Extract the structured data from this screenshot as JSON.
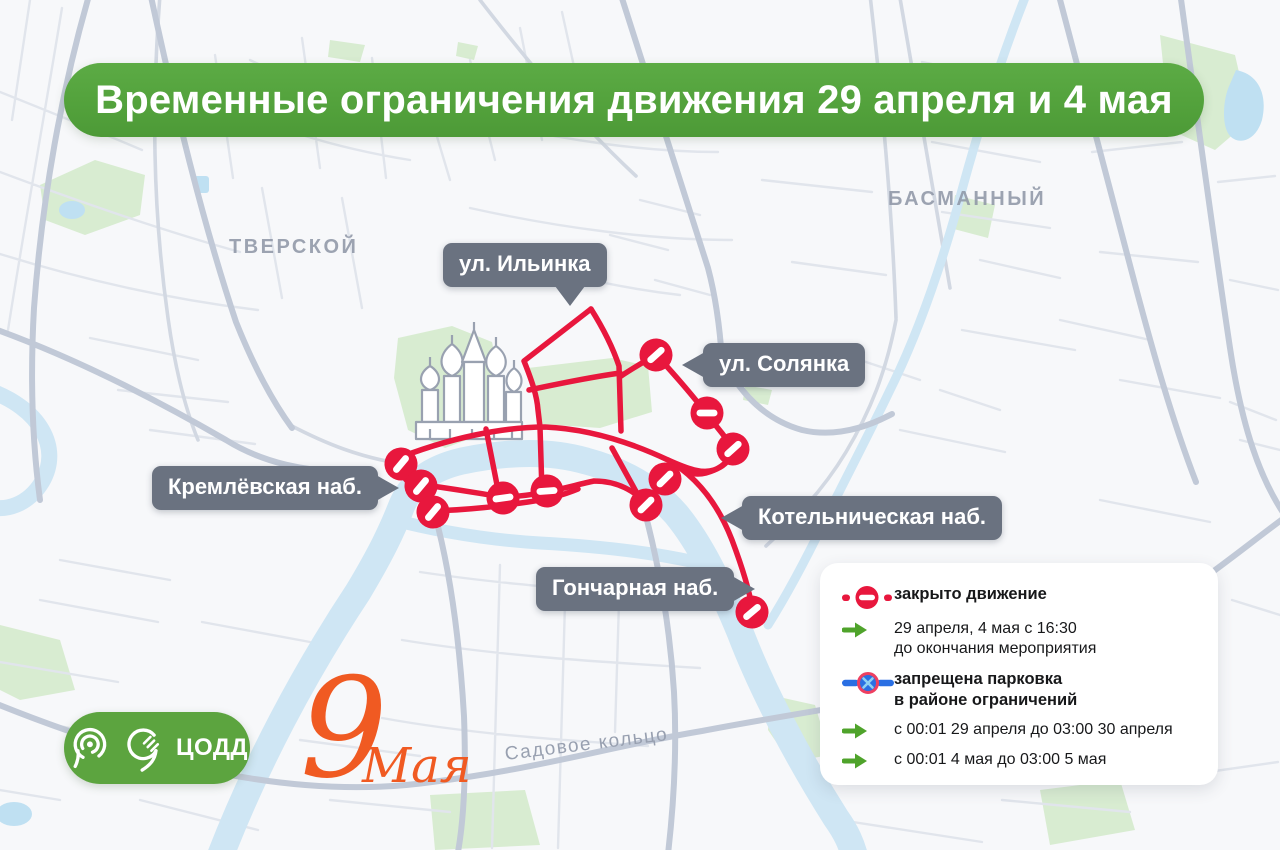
{
  "banner": {
    "title": "Временные ограничения движения 29 апреля и 4 мая"
  },
  "districts": {
    "tverskoy": "ТВЕРСКОЙ",
    "basmanny": "БАСМАННЫЙ"
  },
  "streets": {
    "ilyinka": "ул. Ильинка",
    "solyanka": "ул. Солянка",
    "kremlevskaya": "Кремлёвская наб.",
    "kotelnicheskaya": "Котельническая наб.",
    "goncharnaya": "Гончарная наб.",
    "sadovoe": "Садовое кольцо"
  },
  "legend": {
    "closed_label": "закрыто движение",
    "closed_schedule_line1": "29 апреля, 4 мая с 16:30",
    "closed_schedule_line2": "до окончания мероприятия",
    "parking_label_line1": "запрещена парковка",
    "parking_label_line2": "в районе ограничений",
    "parking_schedule_1": "с 00:01 29 апреля до 03:00 30 апреля",
    "parking_schedule_2": "с 00:01 4 мая до 03:00 5 мая"
  },
  "footer": {
    "org": "ЦОДД",
    "event_digit": "9",
    "event_word": "Мая"
  },
  "icons": {
    "no_entry": "no-entry-sign",
    "schedule_arrow": "green-arrow",
    "no_parking": "no-parking-sign",
    "cathedral": "st-basils-cathedral",
    "transport_logo": "moscow-transport-pin",
    "codd_logo": "codd-pin"
  },
  "colors": {
    "banner_green": "#53a23c",
    "route_red": "#e8173d",
    "tag_gray": "#6a7280",
    "arrow_green": "#4fa32b",
    "parking_blue": "#2a6fe3",
    "may9_orange": "#f05a22",
    "river_blue": "#cfe6f4",
    "park_green": "#d8ecd1"
  }
}
